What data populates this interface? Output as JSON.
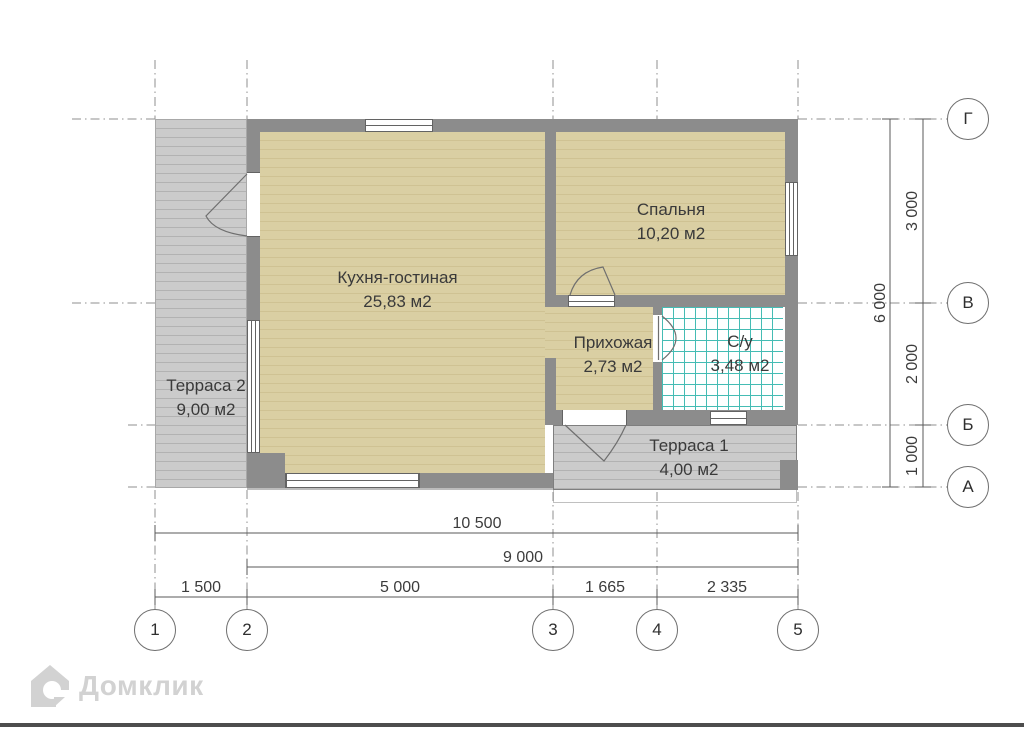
{
  "plan": {
    "rooms": [
      {
        "name": "Кухня-гостиная",
        "area": "25,83 м2"
      },
      {
        "name": "Спальня",
        "area": "10,20 м2"
      },
      {
        "name": "Прихожая",
        "area": "2,73 м2"
      },
      {
        "name": "С/у",
        "area": "3,48 м2"
      },
      {
        "name": "Терраса 1",
        "area": "4,00 м2"
      },
      {
        "name": "Терраса 2",
        "area": "9,00 м2"
      }
    ],
    "axes": {
      "columns": [
        "1",
        "2",
        "3",
        "4",
        "5"
      ],
      "rows": [
        "Г",
        "В",
        "Б",
        "А"
      ]
    },
    "dimensions": {
      "bottom": {
        "total": "10 500",
        "inner": "9 000",
        "segments": [
          "1 500",
          "5 000",
          "1 665",
          "2 335"
        ]
      },
      "right": {
        "total": "6 000",
        "segments": [
          "3 000",
          "2 000",
          "1 000"
        ]
      }
    }
  },
  "branding": {
    "logo_text": "Домклик"
  },
  "colors": {
    "wall": "#8c8c8c",
    "floor_wood": "#dacfa3",
    "floor_terrace": "#cbcbcb",
    "tile_line": "#45bcb4",
    "dimension_text": "#3c3c3c",
    "logo": "#d2d2d2",
    "bottom_bar": "#4d4d4d"
  }
}
